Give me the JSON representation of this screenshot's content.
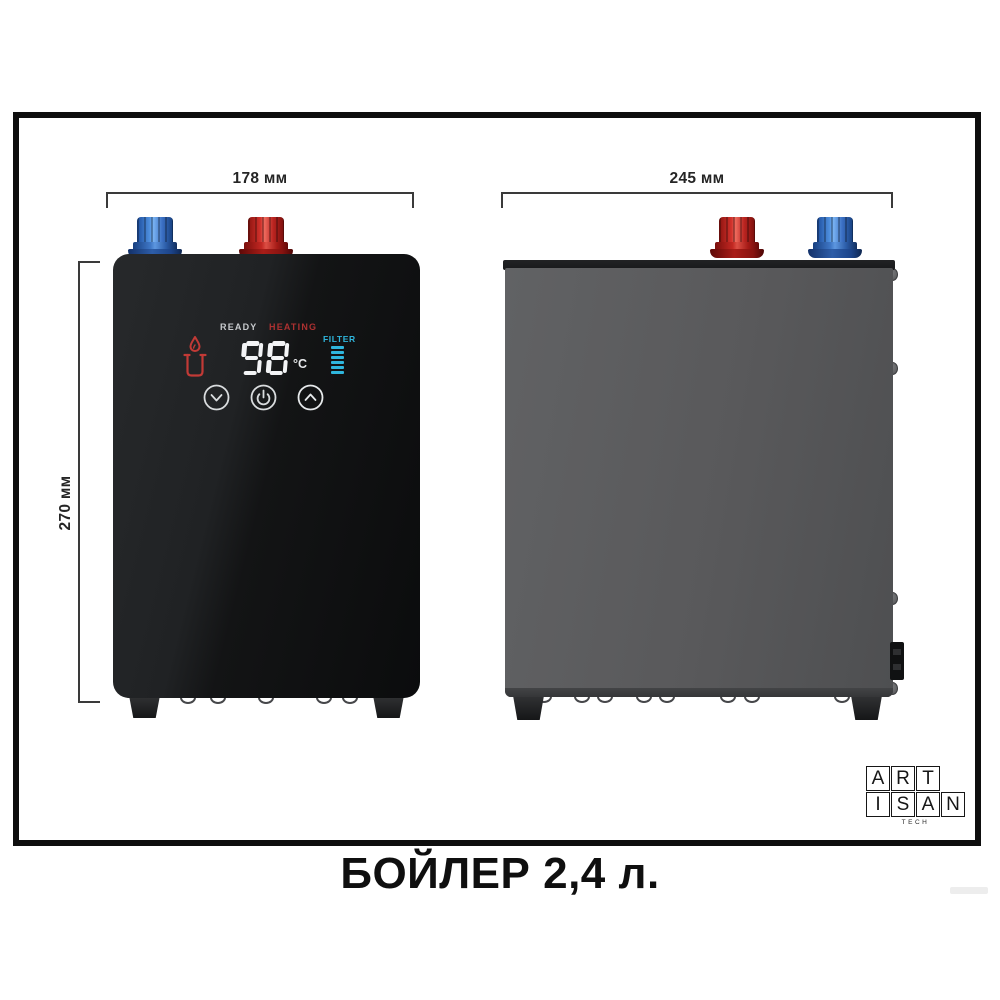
{
  "product": {
    "caption": "БОЙЛЕР 2,4 л."
  },
  "dimensions": {
    "front_width": "178 мм",
    "side_width": "245 мм",
    "height": "270 мм"
  },
  "display": {
    "ready_label": "READY",
    "heating_label": "HEATING",
    "temperature_value": "98",
    "temperature_unit": "°C",
    "filter_label": "FILTER",
    "filter_bar_count": 6,
    "buttons": [
      {
        "name": "temperature-down",
        "icon": "chevron-down-icon"
      },
      {
        "name": "power",
        "icon": "power-icon"
      },
      {
        "name": "temperature-up",
        "icon": "chevron-up-icon"
      }
    ],
    "status_icon": "hot-cup-flame-icon"
  },
  "logo": {
    "rows": [
      "ART",
      "ISAN"
    ],
    "tagline": "TECH"
  },
  "colors": {
    "hot_red": "#cf2a24",
    "cold_blue": "#2f76d2",
    "display_cyan": "#2fb6dd",
    "display_red": "#ad3131",
    "front_black": "#17181a",
    "side_gray": "#58585a",
    "frame_border": "#0e0e0e"
  }
}
